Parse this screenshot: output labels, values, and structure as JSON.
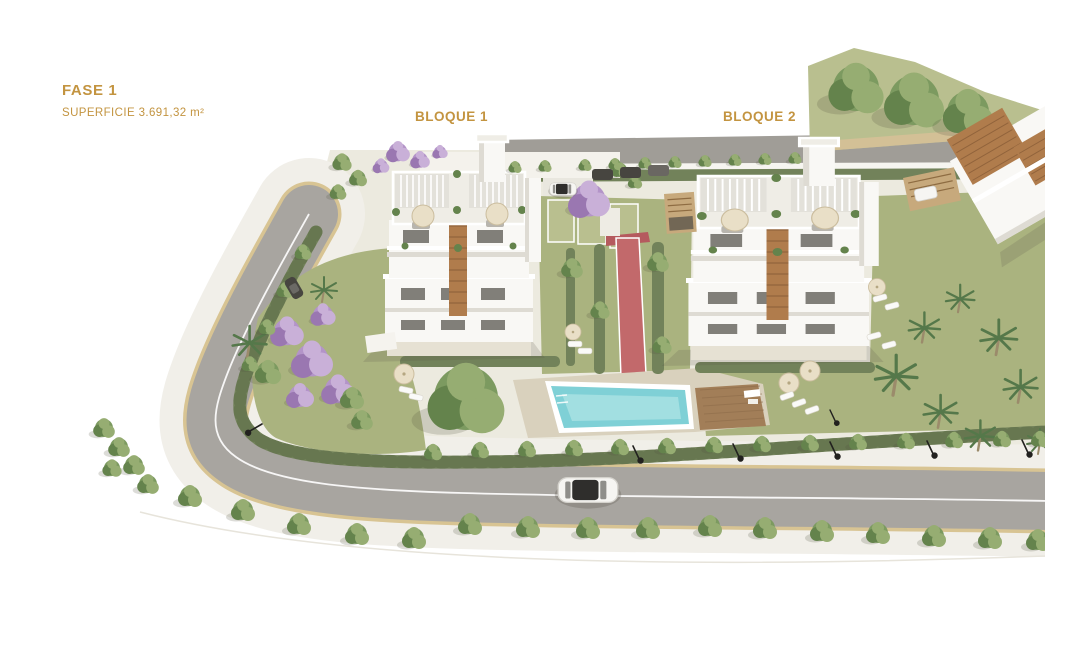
{
  "annotations": {
    "fase_label": "FASE 1",
    "superficie_label": "SUPERFICIE 3.691,32 m²",
    "bloque1_label": "BLOQUE 1",
    "bloque2_label": "BLOQUE 2"
  },
  "colors": {
    "background": "#ffffff",
    "label_gold": "#c39440",
    "road_gray": "#a8a5a0",
    "road_top": "#a09d97",
    "sidewalk": "#f1efe9",
    "curb_tan": "#d8c493",
    "paving": "#eceadf",
    "lawn": "#aab37f",
    "lawn_light": "#b9bf8f",
    "hedge": "#72825a",
    "hedge_dark": "#5f7049",
    "tree_green": "#7c9a60",
    "tree_dark": "#64834c",
    "tree_light": "#96ad72",
    "jacaranda": "#b394c8",
    "jacaranda_dark": "#9a77b1",
    "jacaranda_light": "#c9b0d8",
    "palm_green": "#55784a",
    "pool_water": "#7fd0d6",
    "pool_water_light": "#a2dfe1",
    "pool_deck": "#d9d1bd",
    "wood_deck": "#a27e58",
    "wood_accent": "#b07c4c",
    "building_white": "#f9f8f5",
    "building_shade": "#dedbd3",
    "window_dark": "#4e4b44",
    "umbrella_cream": "#e9dfc7",
    "path_pink": "#c2696b",
    "car_white": "#f6f5f2",
    "car_dark": "#474540",
    "lamp_black": "#22211f",
    "fence_white": "#f6f5f0",
    "shadow": "rgba(90,85,70,0.18)"
  }
}
